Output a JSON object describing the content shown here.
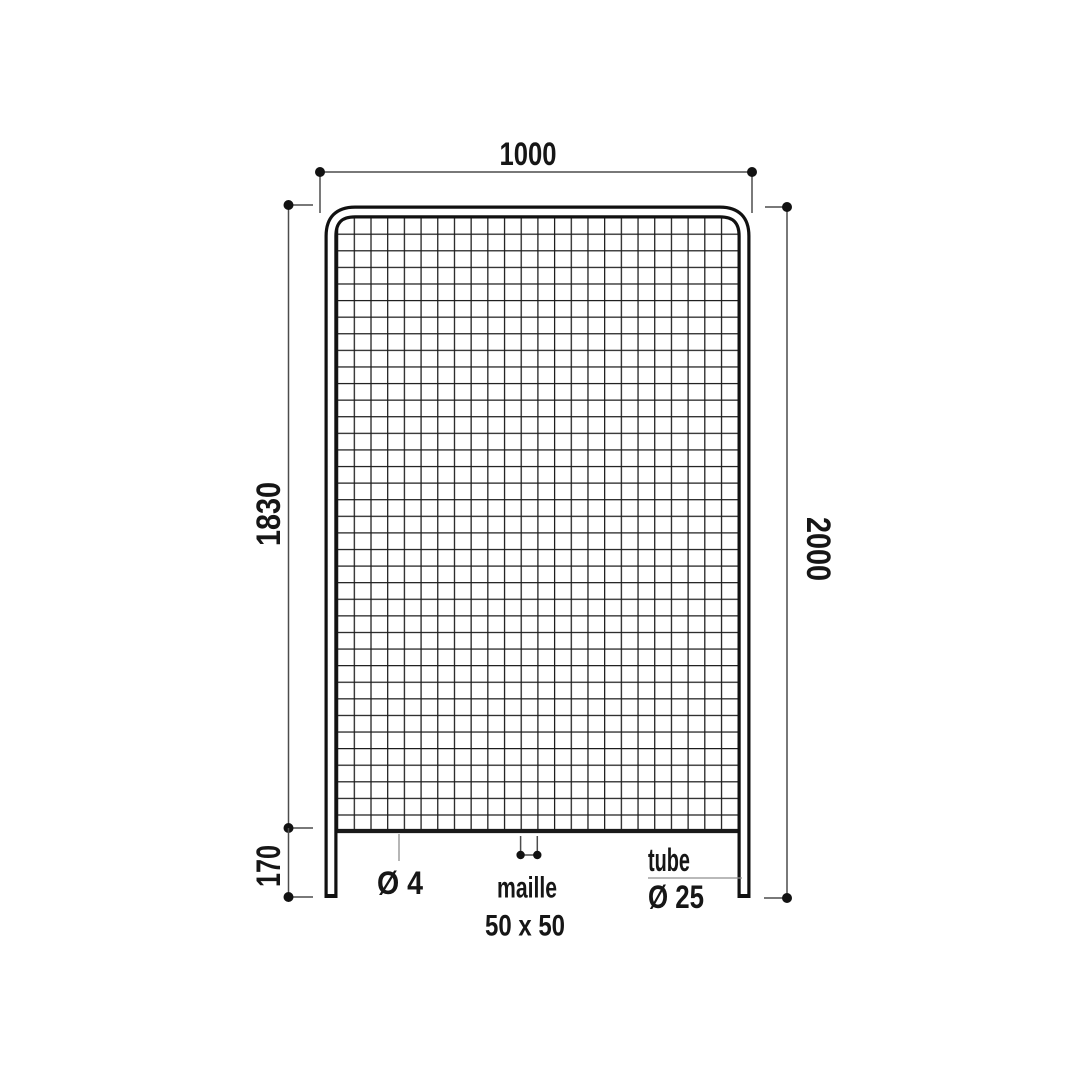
{
  "diagram": {
    "kind": "technical drawing",
    "subject": "wire mesh fence panel with tube frame",
    "background_color": "#ffffff",
    "ink_color": "#1a1a1a",
    "dimensions": {
      "overall_width": "1000",
      "overall_height": "2000",
      "mesh_height": "1830",
      "ground_clearance": "170"
    },
    "callouts": {
      "wire_diameter": "Ø 4",
      "mesh_line1": "maille",
      "mesh_line2": "50 x 50",
      "tube_line1": "tube",
      "tube_line2": "Ø 25"
    }
  }
}
